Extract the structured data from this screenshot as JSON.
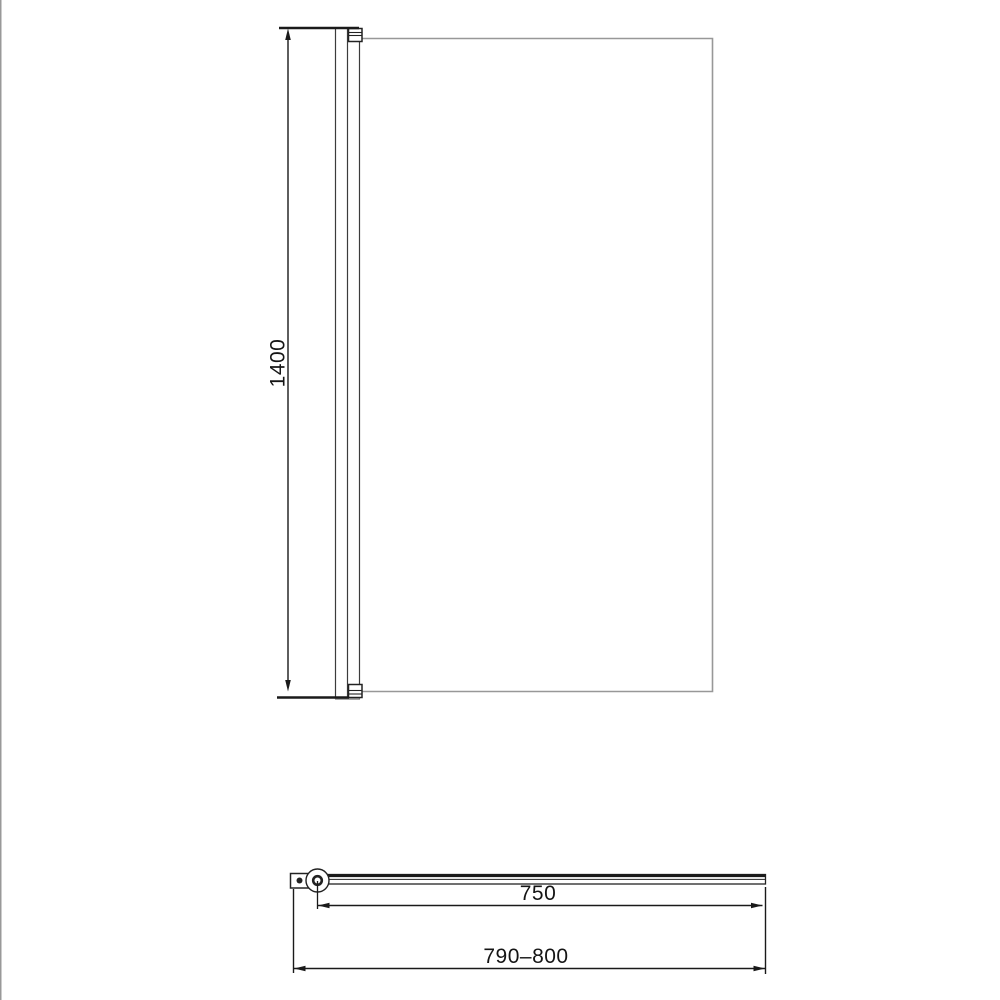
{
  "drawing": {
    "front_view": {
      "height_dimension_label": "1400"
    },
    "plan_view": {
      "glass_width_dimension_label": "750",
      "overall_width_dimension_label": "790–800"
    },
    "colors": {
      "dimension_line": "#1a1a1a",
      "profile_line": "#3c3c3c",
      "glass_edge": "#989898",
      "background": "#ffffff",
      "left_edge_strip": "#999999"
    }
  }
}
